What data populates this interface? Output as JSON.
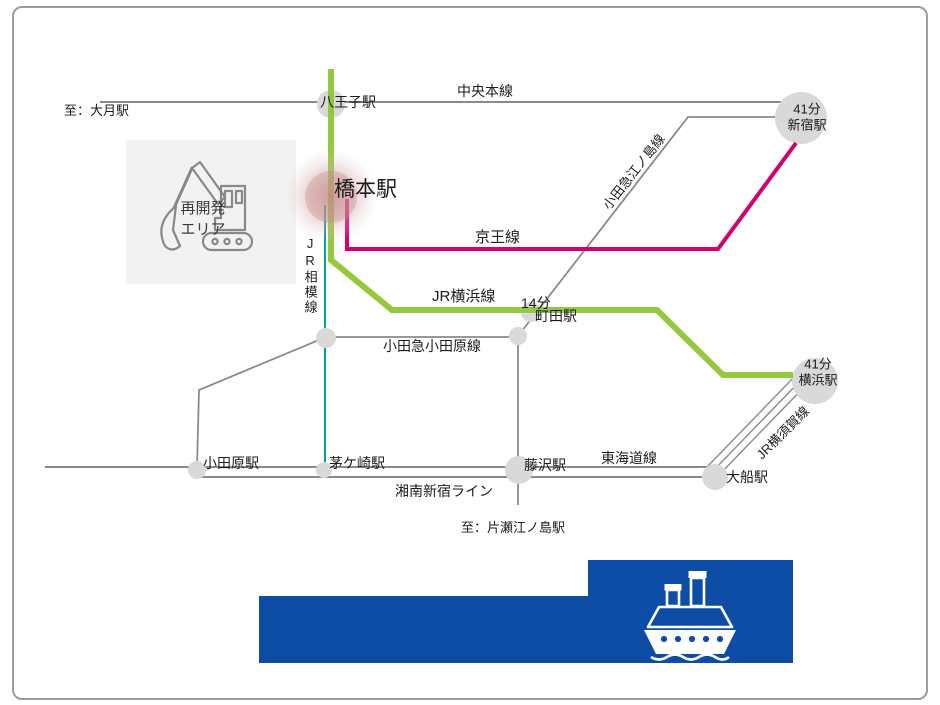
{
  "colors": {
    "ink": "#1c1c1c",
    "gray": "#8a8a8a",
    "green": "#94c83e",
    "magenta": "#d30070",
    "teal": "#00a0a0",
    "circle": "#d9d9d9",
    "blue": "#0d4da6",
    "areabg": "#f2f2f2",
    "icongray": "#898989",
    "frame": "#9c9c9c",
    "areatext": "#3a3a3a",
    "glow": "#c98a8a"
  },
  "endpoints": {
    "otsuki": "至：大月駅",
    "katase": "至：片瀬江ノ島駅"
  },
  "area": {
    "line1": "再開発",
    "line2": "エリア"
  },
  "stations": {
    "hachioji": {
      "label": "八王子駅"
    },
    "shinjuku": {
      "minutes": "41分",
      "label": "新宿駅"
    },
    "hashimoto": {
      "label": "橋本駅"
    },
    "machida": {
      "minutes": "14分",
      "label": "町田駅"
    },
    "yokohama": {
      "minutes": "41分",
      "label": "横浜駅"
    },
    "odawara": {
      "label": "小田原駅"
    },
    "chigasaki": {
      "label": "茅ケ崎駅"
    },
    "fujisawa": {
      "label": "藤沢駅"
    },
    "ofuna": {
      "label": "大船駅"
    }
  },
  "lines": {
    "chuo": {
      "label": "中央本線"
    },
    "keio": {
      "label": "京王線"
    },
    "jr_yokohama": {
      "label": "JR横浜線"
    },
    "jr_sagami": {
      "label": "JR相模線"
    },
    "odakyu_odawara": {
      "label": "小田急小田原線"
    },
    "odakyu_enoshima": {
      "label": "小田急江ノ島線"
    },
    "tokaido": {
      "label": "東海道線"
    },
    "shonan_shinjuku": {
      "label": "湘南新宿ライン"
    },
    "jr_yokosuka": {
      "label": "JR横須賀線"
    }
  },
  "icons": {
    "excavator": "excavator-icon",
    "ship": "ship-icon"
  }
}
